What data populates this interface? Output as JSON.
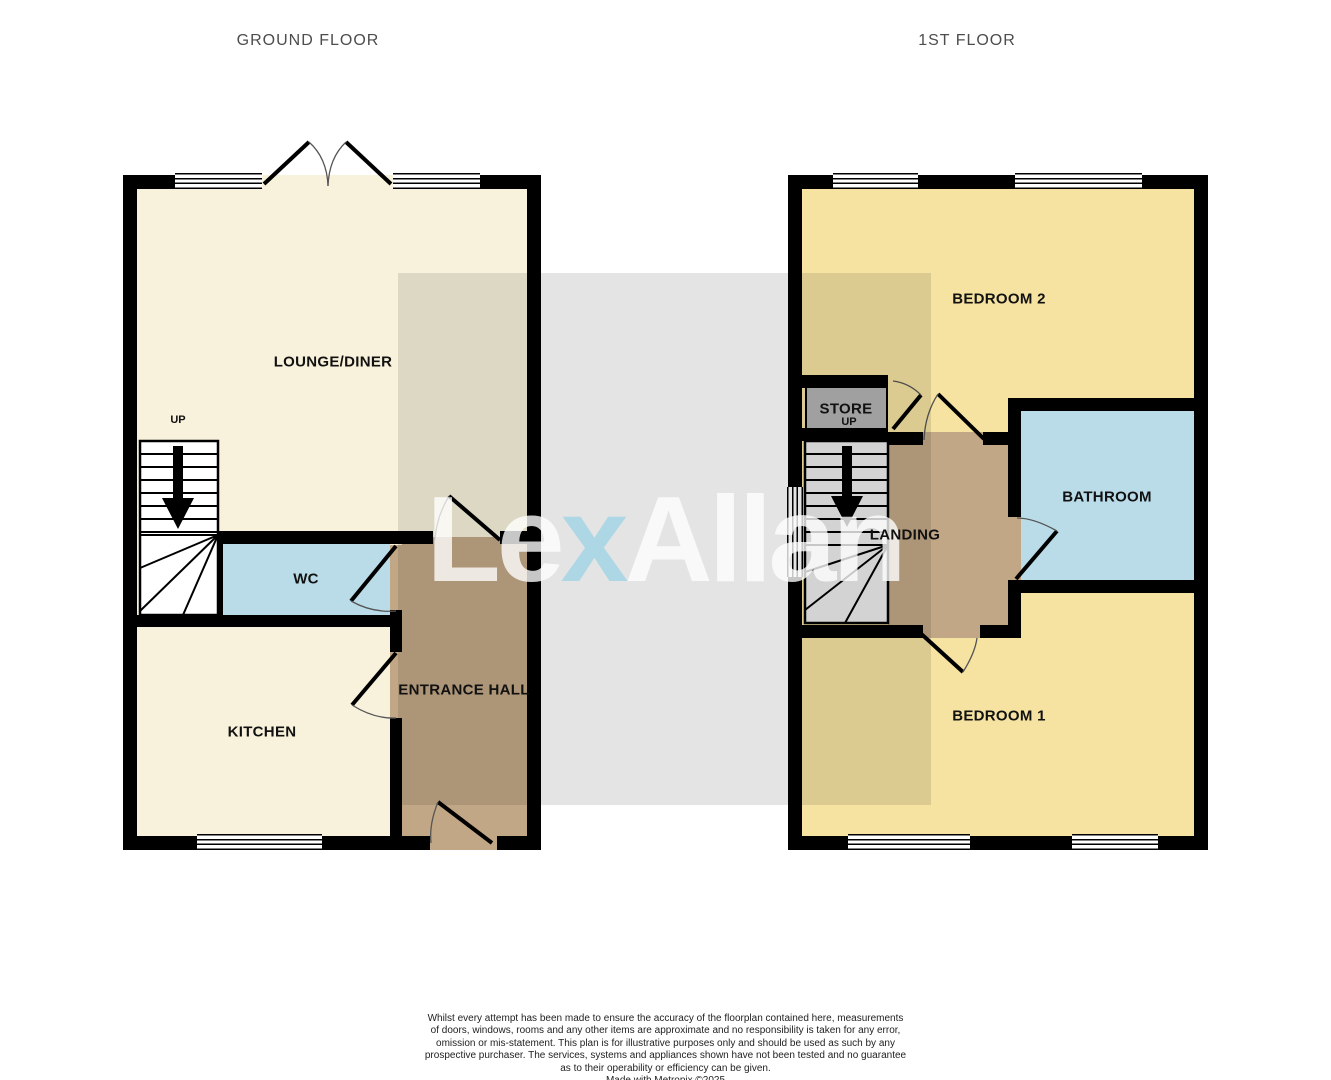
{
  "floors": {
    "ground": {
      "title": "GROUND FLOOR",
      "rooms": {
        "lounge": {
          "label": "LOUNGE/DINER"
        },
        "wc": {
          "label": "WC"
        },
        "kitchen": {
          "label": "KITCHEN"
        },
        "hall": {
          "label": "ENTRANCE HALL"
        }
      },
      "stairs": {
        "label": "UP"
      }
    },
    "first": {
      "title": "1ST FLOOR",
      "rooms": {
        "bedroom2": {
          "label": "BEDROOM 2"
        },
        "store": {
          "label": "STORE",
          "sub": "UP"
        },
        "landing": {
          "label": "LANDING"
        },
        "bathroom": {
          "label": "BATHROOM"
        },
        "bedroom1": {
          "label": "BEDROOM 1"
        }
      }
    }
  },
  "watermark": {
    "part1": "Le",
    "part2": "x",
    "part3": "Allan"
  },
  "disclaimer": {
    "lines": [
      "Whilst every attempt has been made to ensure the accuracy of the floorplan contained here, measurements",
      "of doors, windows, rooms and any other items are approximate and no responsibility is taken for any error,",
      "omission or mis-statement. This plan is for illustrative purposes only and should be used as such by any",
      "prospective purchaser. The services, systems and appliances shown have not been tested and no guarantee",
      "as to their operability or efficiency can be given.",
      "Made with Metropix ©2025"
    ]
  },
  "colors": {
    "wall": "#000000",
    "lounge_kitchen_floor": "#f8f2dc",
    "bedroom_floor": "#f6e3a1",
    "wc_bathroom_floor": "#b9dce8",
    "hall_landing_floor": "#c2a787",
    "store_floor": "#b3b3b3",
    "first_floor_stairs": "#ececec",
    "watermark_accent": "#a3d5e4"
  }
}
